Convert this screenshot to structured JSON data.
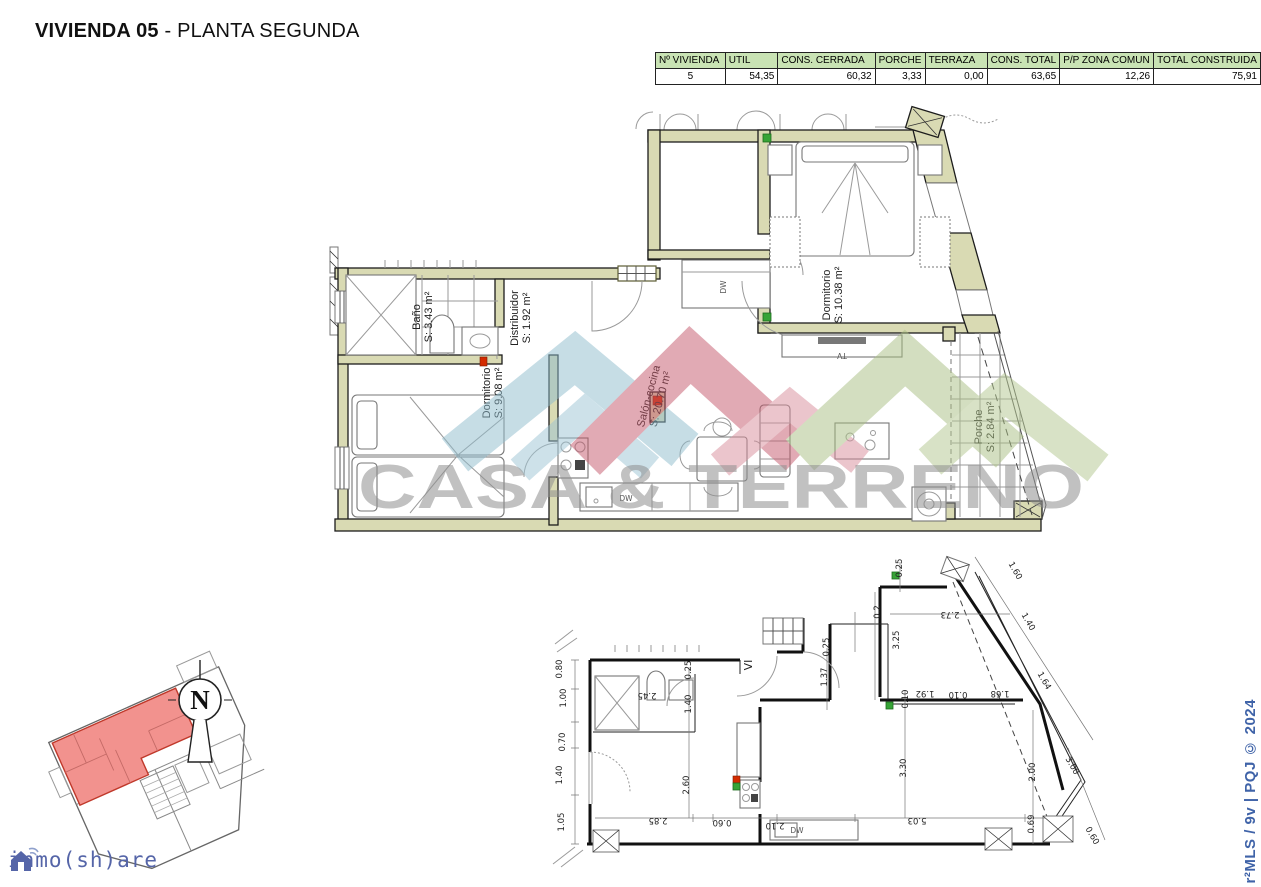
{
  "page": {
    "title_bold": "VIVIENDA 05",
    "title_rest": " - PLANTA SEGUNDA"
  },
  "summary_table": {
    "headers": [
      "Nº VIVIENDA",
      "UTIL",
      "CONS. CERRADA",
      "PORCHE",
      "TERRAZA",
      "CONS. TOTAL",
      "P/P ZONA COMUN",
      "TOTAL CONSTRUIDA"
    ],
    "values": [
      "5",
      "54,35",
      "60,32",
      "3,33",
      "0,00",
      "63,65",
      "12,26",
      "75,91"
    ]
  },
  "main_plan": {
    "rooms": [
      {
        "name": "Baño",
        "area": "S: 3.43 m²"
      },
      {
        "name": "Distribuidor",
        "area": "S: 1.92 m²"
      },
      {
        "name": "Dormitorio",
        "area": "S: 9.08 m²"
      },
      {
        "name": "Salón-cocina",
        "area": "S: 20.70 m²"
      },
      {
        "name": "Dormitorio",
        "area": "S: 10.38 m²"
      },
      {
        "name": "Porche",
        "area": "S: 2.84 m²"
      }
    ],
    "appliances": {
      "dw_closet": "DW",
      "dw_kitchen": "DW",
      "tv": "TV"
    }
  },
  "dim_plan": {
    "label_vi": "VI",
    "label_dw": "DW",
    "dims": [
      "0.80",
      "1.00",
      "0.70",
      "1.40",
      "1.05",
      "2.45",
      "0.25",
      "1.40",
      "1.37",
      "0.25",
      "0.2",
      "0.25",
      "2.73",
      "3.25",
      "1.92",
      "0.10",
      "1.68",
      "0.10",
      "1.60",
      "1.40",
      "1.64",
      "2.00",
      "3.00",
      "0.69",
      "0.60",
      "2.60",
      "2.85",
      "0.60",
      "2.10",
      "5.03",
      "3.30"
    ]
  },
  "watermark": {
    "text": "CASA & TERRENO"
  },
  "compass": {
    "label": "N"
  },
  "branding": {
    "logo_text": "inmo(sh)are"
  },
  "footer": {
    "copyright": "r²MLS / 9v | PQJ © 2024"
  },
  "colors": {
    "wall": "#d9dab3",
    "table_header": "#c9e3b4",
    "highlight_unit": "#f2928e",
    "brand_blue": "#3f63a8",
    "wm_blue": "#8fbccd",
    "wm_red": "#c4586b",
    "wm_green": "#a9bf82"
  }
}
